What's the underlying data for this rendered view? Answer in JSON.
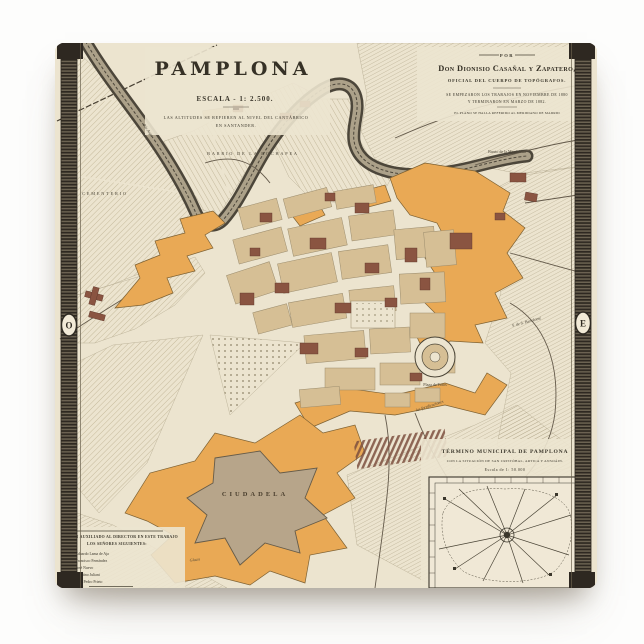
{
  "product": {
    "alt": "Vintage 1882 map of Pamplona printed on a square ceramic tile"
  },
  "map": {
    "title": "PAMPLONA",
    "scale_label": "ESCALA - 1: 2.500.",
    "note_line1": "LAS ALTITUDES SE REFIEREN AL NIVEL DEL CANTÁBRICO",
    "note_line2": "EN SANTANDER.",
    "attribution": {
      "por": "POR",
      "author": "Don Dionisio Casañal y Zapatero,",
      "role": "OFICIAL DEL CUERPO DE TOPÓGRAFOS.",
      "dates_line1": "SE EMPEZARON LOS TRABAJOS EN NOVIEMBRE DE 1880",
      "dates_line2": "Y TERMINARON EN MARZO DE 1882.",
      "footnote": "EL PLANO SE HALLA REFERIDO AL MERIDIANO DE MADRID"
    },
    "edge_letters": {
      "west": "O",
      "east": "E"
    },
    "labels": {
      "cementerio": "CEMENTERIO",
      "rochapea": "BARRIO DE LA ROCHAPEA",
      "magdalena": "Barrio de la Magdalena",
      "rio_arga": "Río Arga",
      "san_bartolome": "F. de S. Bartolomé",
      "fortificaciones": "las fortificaciones",
      "plaza_toros": "Plaza de Toros",
      "ciudadela": "CIUDADELA",
      "glacis": "Glacis"
    },
    "legend": {
      "header1": "HAN AUXILIADO AL DIRECTOR EN ESTE TRABAJO",
      "header2": "LOS SEÑORES SIGUIENTES:",
      "names": [
        "D. Eduardo Lama de Aja",
        "D. Francisco Fernández",
        "D. José Nuevo",
        "D. Faustino Juliani",
        "D. Juan Pedro Prieto"
      ]
    },
    "inset": {
      "title": "TÉRMINO MUNICIPAL DE PAMPLONA",
      "subtitle": "CON LA SITUACIÓN DE SAN CRISTÓBAL, ARTICA Y ANSOÁIN.",
      "scale": "Escala de 1: 50.000"
    },
    "colors": {
      "paper": "#ece4cf",
      "wall_orange": "#e9a955",
      "city_tan": "#d6bf95",
      "building_brown": "#8a5441",
      "ink": "#3b372c"
    }
  }
}
